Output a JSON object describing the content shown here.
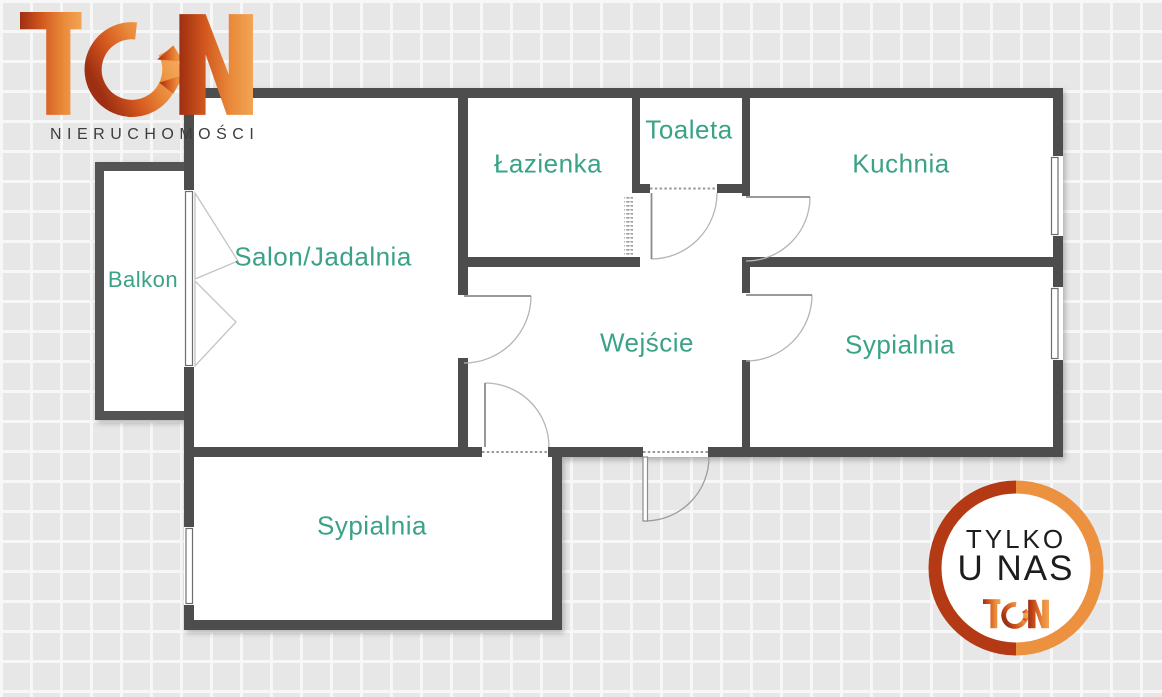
{
  "brand": {
    "logo_text": "TGN",
    "subtitle": "NIERUCHOMOŚCI",
    "gradient_start": "#9e2f12",
    "gradient_mid": "#d3571e",
    "gradient_end": "#f3a455",
    "subtitle_color": "#3d3d3d"
  },
  "floorplan": {
    "wall_color": "#4d4d4d",
    "room_fill": "#ffffff",
    "label_color": "#3aa287",
    "door_line_color": "#8c8c8c",
    "rooms": {
      "balkon": "Balkon",
      "salon": "Salon/Jadalnia",
      "lazienka": "Łazienka",
      "toaleta": "Toaleta",
      "kuchnia": "Kuchnia",
      "wejscie": "Wejście",
      "sypialnia_prawa": "Sypialnia",
      "sypialnia_dolna": "Sypialnia"
    }
  },
  "badge": {
    "line1": "TYLKO",
    "line2": "U NAS",
    "logo_text": "TGN",
    "ring_left": "#b43a15",
    "ring_right": "#ec9140",
    "text_color": "#1d1d1d"
  }
}
